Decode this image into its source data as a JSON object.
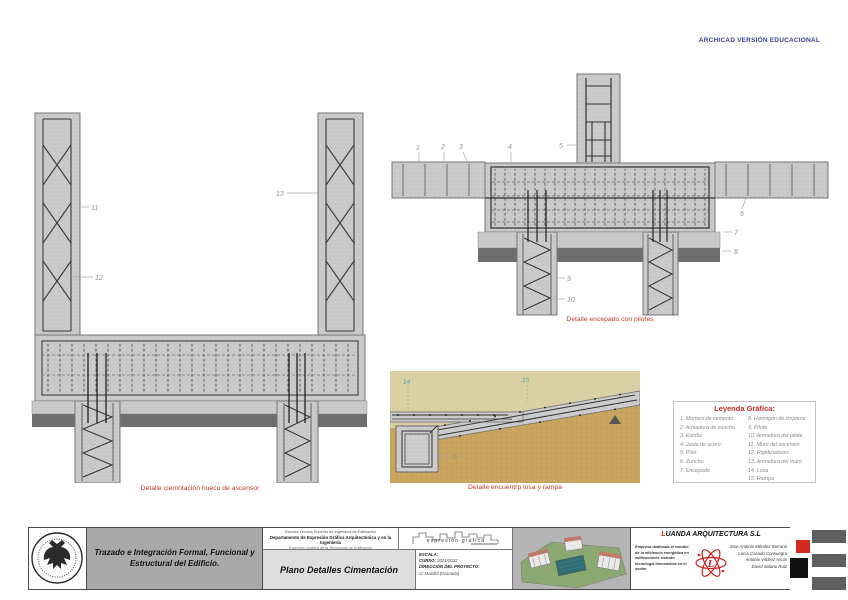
{
  "page": {
    "archicad_banner": "ARCHICAD VERSIÓN EDUCACIONAL"
  },
  "colors": {
    "caption_red": "#c0392b",
    "archicad_blue": "#3d3da0",
    "callout_gray": "#949494",
    "callout_teal": "#53a79c",
    "brand_red": "#cc2222",
    "concrete_gray": "#cccccc",
    "soil_tan": "#c9a45e"
  },
  "captions": {
    "elevator": "Detalle ciemntación hueco de ascensor",
    "pilecap": "Detalle  encepado con pilotes",
    "ramp": "Detalle encuentrp losa y rampa"
  },
  "callouts": {
    "elevator": {
      "n11": "11",
      "n12": "12",
      "n13": "13"
    },
    "pilecap": {
      "n1": "1",
      "n2": "2",
      "n3": "3",
      "n4": "4",
      "n5": "5",
      "n6": "6",
      "n7": "7",
      "n8": "8",
      "n9": "9",
      "n10": "10"
    },
    "ramp": {
      "n14": "14",
      "n15": "15",
      "n6": "6"
    }
  },
  "legend": {
    "title": "Leyenda Gráfica:",
    "left": [
      "1. Mortero de cemento",
      "2. Armadura de zuncho",
      "3. Estribo",
      "4. Jaula de acero",
      "5. Pilar",
      "6. Zuncho",
      "7. Encepado"
    ],
    "right": [
      "8. Hormigón de limpieza",
      "9. Pilote",
      "10. Armadura del pilote",
      "11. Muro del ascensor",
      "12. Rigidizadores",
      "13. Armadura del muro",
      "14. Losa",
      "15. Rampa"
    ]
  },
  "titleblock": {
    "project_title_line1": "Trazado e Integración Formal, Funcional y",
    "project_title_line2": "Estructural del Edificio.",
    "school": "Escuela Técnica Superior de Ingeniería de Edificación",
    "department": "Departamento de Expresión Gráfica Arquitectónica y en la Ingeniería",
    "subject": "Expresión Gráfica de la Tecnología de Edificación",
    "sheet_title": "Plano Detalles Cimentación",
    "scale_label": "ESCALA:",
    "course_label": "CURSO:",
    "course_value": "2021/2022",
    "address_label": "DIRECCIÓN  DEL PROYECTO:",
    "address_value": "C/ Malahá (Granada)",
    "eg_logo_text": "expresión gráfica",
    "company": {
      "name_initial": "L",
      "name_rest": "UANDA ARQUITECTURA S.L",
      "description": "Empresa dedicada al estudio de la eficiencia energética en edificaciones usando tecnología innovadora en el sector",
      "members": [
        "Jose Antonio Méndez Serrano",
        "Lucía Casado Consuegra",
        "Antonio Vilchez Arcos",
        "David Solano Ruiz"
      ]
    }
  }
}
